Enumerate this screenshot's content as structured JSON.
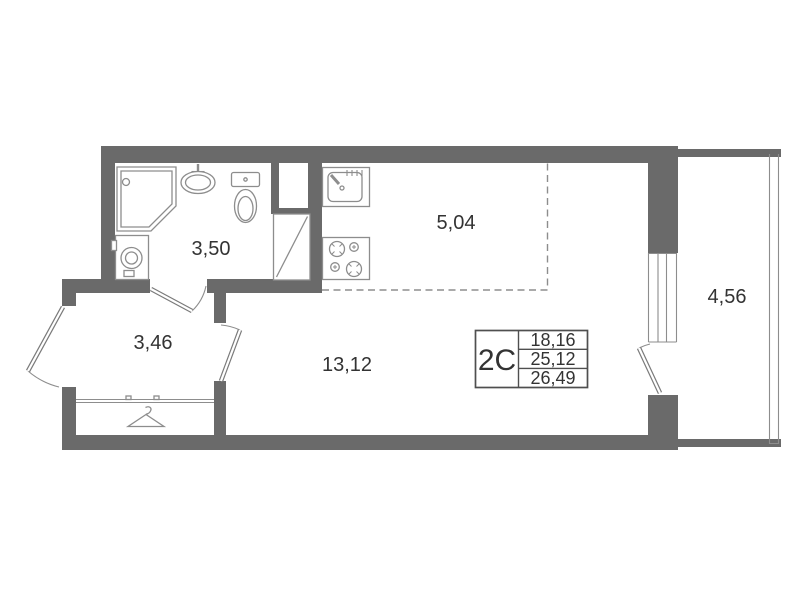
{
  "plan": {
    "rooms": [
      {
        "name": "bathroom",
        "area": "3,50"
      },
      {
        "name": "kitchen",
        "area": "5,04"
      },
      {
        "name": "hallway",
        "area": "3,46"
      },
      {
        "name": "living-room",
        "area": "13,12"
      },
      {
        "name": "balcony",
        "area": "4,56"
      }
    ],
    "info_box": {
      "type_label": "2С",
      "values": [
        "18,16",
        "25,12",
        "26,49"
      ]
    },
    "fixtures": [
      "shower-cabin",
      "washbasin",
      "toilet",
      "washing-machine",
      "kitchen-sink",
      "stove-4-burners",
      "wardrobe-hanger"
    ],
    "colors": {
      "wall": "#6a6a6a",
      "fixture_line": "#8d8d8d",
      "door_line": "#7a7a7a",
      "text": "#333333"
    }
  }
}
